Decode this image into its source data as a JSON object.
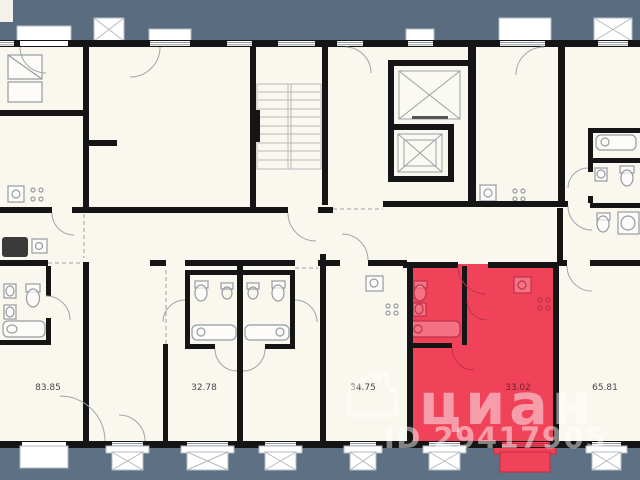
{
  "page": {
    "type": "residential-floor-plan"
  },
  "colors": {
    "background_top": "#5a6c7f",
    "background_bottom": "#5e7184",
    "floor": "#f9f7ee",
    "walls": "#151515",
    "highlight": "#f0435a",
    "highlight_dark": "#c52b40",
    "fixtures": "#969ca1",
    "label_text": "#474750"
  },
  "apartments": [
    {
      "area": "83.85",
      "highlighted": false
    },
    {
      "area": "32.78",
      "highlighted": false
    },
    {
      "area": "34.75",
      "highlighted": false
    },
    {
      "area": "33.02",
      "highlighted": true
    },
    {
      "area": "65.81",
      "highlighted": false
    }
  ],
  "watermark": {
    "brand": "циан",
    "listing_id": "ID 29417905"
  },
  "icons": {
    "elevator_shaft_icon": "crossed-box",
    "balcony_icon": "crossed-box",
    "staircase_icon": "stair-treads",
    "house_logo_icon": "house-outline"
  }
}
